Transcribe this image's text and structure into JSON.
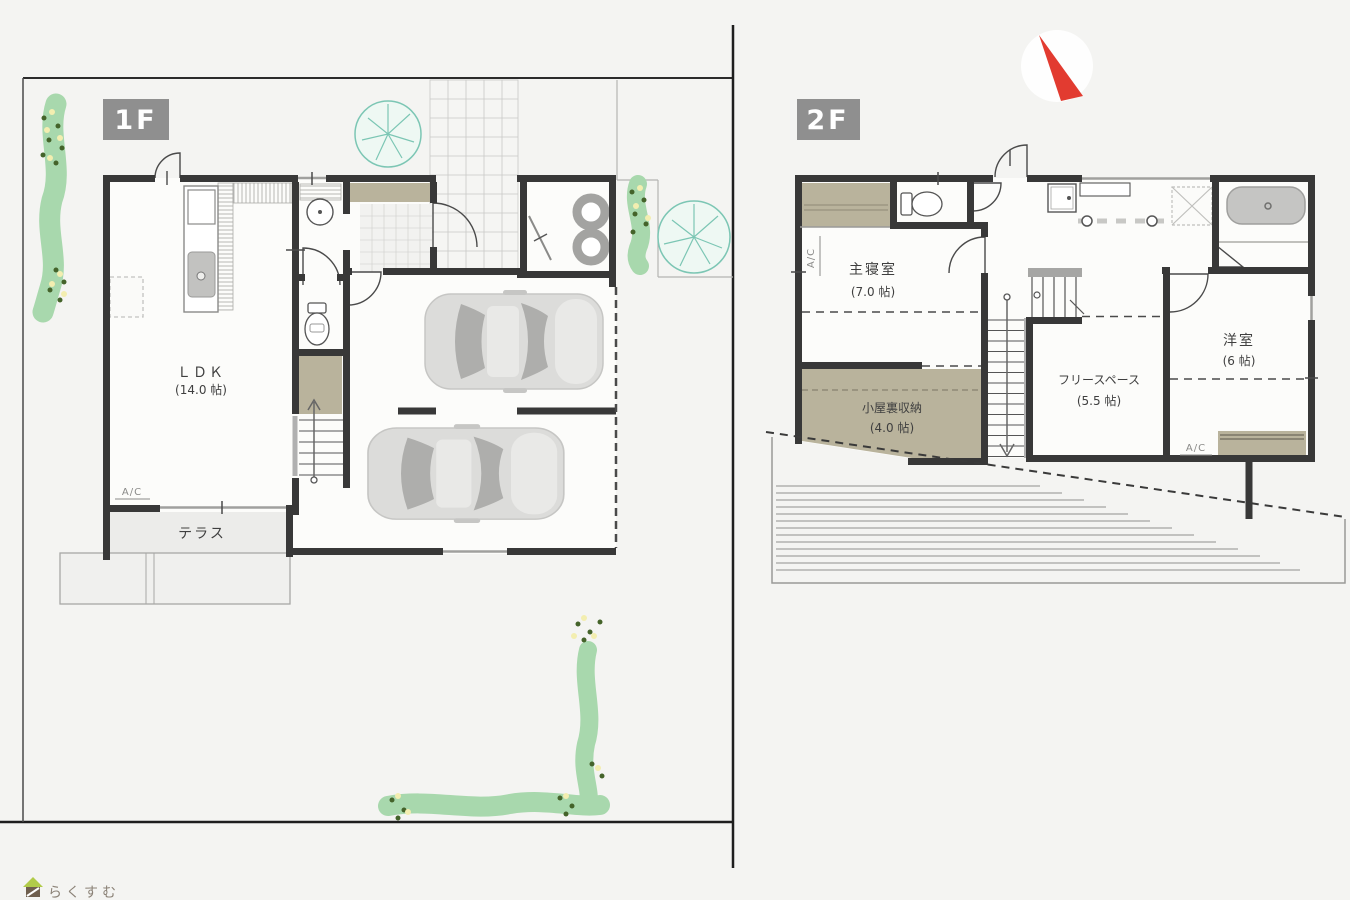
{
  "floor1": {
    "badge": "1F",
    "ldk_name": "ＬＤＫ",
    "ldk_size": "(14.0 帖)",
    "terrace": "テラス",
    "ac": "A/C"
  },
  "floor2": {
    "badge": "2F",
    "master_name": "主寝室",
    "master_size": "(7.0 帖)",
    "attic_name": "小屋裏収納",
    "attic_size": "(4.0 帖)",
    "free_name": "フリースペース",
    "free_size": "(5.5 帖)",
    "western_name": "洋室",
    "western_size": "(6 帖)",
    "ac_left": "A/C",
    "ac_right": "A/C"
  },
  "logo": {
    "text": "らくすむ"
  },
  "colors": {
    "background": "#f4f4f2",
    "wall": "#383838",
    "storage_olive": "#b9b39c",
    "hedge_green": "#a8d8ad",
    "tree_teal": "#7cc6b4",
    "badge_gray": "#8f8f8f",
    "compass_red": "#e23b30",
    "fixture_gray": "#c2c2c0"
  }
}
